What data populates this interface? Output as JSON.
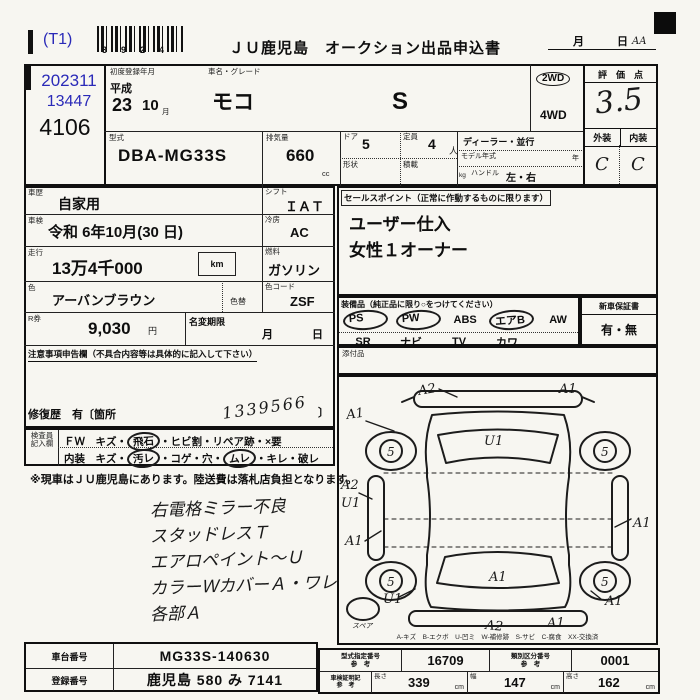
{
  "colors": {
    "accent_blue": "#2a2ab8",
    "ink": "#161616",
    "paper": "#f7f6f1"
  },
  "header": {
    "t1": "(T1)",
    "barcode_digits": "3924",
    "title": "ＪＵ鹿児島　オークション出品申込書",
    "month_label": "月",
    "day_label": "日",
    "scribble": "AA"
  },
  "id_box": {
    "auction_date": "202311",
    "entry_no": "13447",
    "lot_no": "4106"
  },
  "vehicle": {
    "first_reg_label": "初度登録年月",
    "name_grade_label": "車名・グレード",
    "era": "平成",
    "reg_year": "23",
    "reg_month": "10",
    "month_unit": "月",
    "car_name": "モコ",
    "grade": "S",
    "wd2": "2WD",
    "wd4": "4WD",
    "model_label": "型式",
    "model": "DBA-MG33S",
    "disp_label": "排気量",
    "disp": "660",
    "disp_unit": "cc",
    "door_label": "ドア",
    "doors": "5",
    "cap_label": "定員",
    "capacity": "4",
    "cap_unit": "人",
    "dealer_label": "ディーラー・並行",
    "model_year_label": "モデル年式",
    "year_unit": "年",
    "kg_unit": "kg",
    "handle_label": "ハンドル",
    "handle_value": "左・右",
    "shape_label": "形状",
    "load_label": "積載"
  },
  "score": {
    "title": "評　価　点",
    "value": "3.5",
    "exterior_label": "外装",
    "interior_label": "内装",
    "exterior": "C",
    "interior": "C"
  },
  "details": {
    "history_label": "車歴",
    "history": "自家用",
    "shift_label": "シフト",
    "shift": "ＩＡＴ",
    "inspection_label": "車検",
    "inspection": "令和 6年10月(30 日)",
    "ac_label": "冷房",
    "ac": "AC",
    "mileage_label": "走行",
    "mileage": "13万4千000",
    "km_unit": "km",
    "fuel_label": "燃料",
    "fuel": "ガソリン",
    "color_label": "色",
    "color": "アーバンブラウン",
    "color_change_label": "色替",
    "color_code_label": "色コード",
    "color_code": "ZSF",
    "rticket_label": "R券",
    "rticket": "9,030",
    "yen": "円",
    "name_change_label": "名変期限",
    "nc_month": "月",
    "nc_day": "日",
    "notes_header": "注意事項申告欄（不具合内容等は具体的に記入して下さい）",
    "repair_prefix": "修復歴　有〔箇所",
    "repair_hand": "1339566",
    "repair_suffix": "〕"
  },
  "sales_points": {
    "label": "セールスポイント（正常に作動するものに限ります）",
    "line1": "ユーザー仕入",
    "line2": "女性１オーナー"
  },
  "equipment": {
    "label": "装備品（純正品に限り○をつけてください）",
    "row1": [
      "PS",
      "PW",
      "ABS",
      "エアB",
      "AW"
    ],
    "row2": [
      "SR",
      "ナビ",
      "TV",
      "カワ",
      ""
    ],
    "warranty_label": "新車保証書",
    "warranty_value": "有・無",
    "attachments_label": "添付品"
  },
  "inspector": {
    "label1": "検査員",
    "label2": "記入欄",
    "row1_parts": [
      "ＦＷ　キズ・",
      "飛石",
      "・ヒビ割・リペア跡・×要"
    ],
    "row2_parts": [
      "内装　キズ・",
      "汚レ",
      "・コゲ・穴・",
      "ムレ",
      "・キレ・破レ"
    ]
  },
  "notice": "※現車はＪＵ鹿児島にあります。陸送費は落札店負担となります。",
  "handwritten_notes": [
    "右電格ミラー不良",
    "スタッドレスＴ",
    "エアロペイント〜Ｕ",
    "カラーＷカバーＡ・ワレ",
    "各部Ａ"
  ],
  "diagram": {
    "marks": {
      "top_left": "A2",
      "top_right": "A1",
      "left_upper": "A1",
      "windshield": "U1",
      "left_mid_a": "A2",
      "left_mid_b": "U1",
      "left_lower": "A1",
      "right_mid": "A1",
      "rear_left": "U1",
      "rear_window": "A1",
      "rear_right": "A1",
      "bottom_center": "A2",
      "bottom_right": "A1"
    },
    "wheel_mark": "5",
    "spare_label": "スペア",
    "legend": "A-キズ　B-エクボ　U-凹ミ　W-補修跡　S-サビ　C-腐食　XX-交換済"
  },
  "footer": {
    "chassis_label": "車台番号",
    "chassis": "MG33S-140630",
    "reg_label": "登録番号",
    "reg": "鹿児島 580 み 7141",
    "type_label": "型式指定番号",
    "ref_label": "参　考",
    "type_no": "16709",
    "class_label": "類別区分番号",
    "class_no": "0001",
    "doc_label": "車検証明記",
    "len_label": "長さ",
    "length": "339",
    "cm": "cm",
    "wid_label": "幅",
    "width": "147",
    "hei_label": "高さ",
    "height": "162"
  }
}
